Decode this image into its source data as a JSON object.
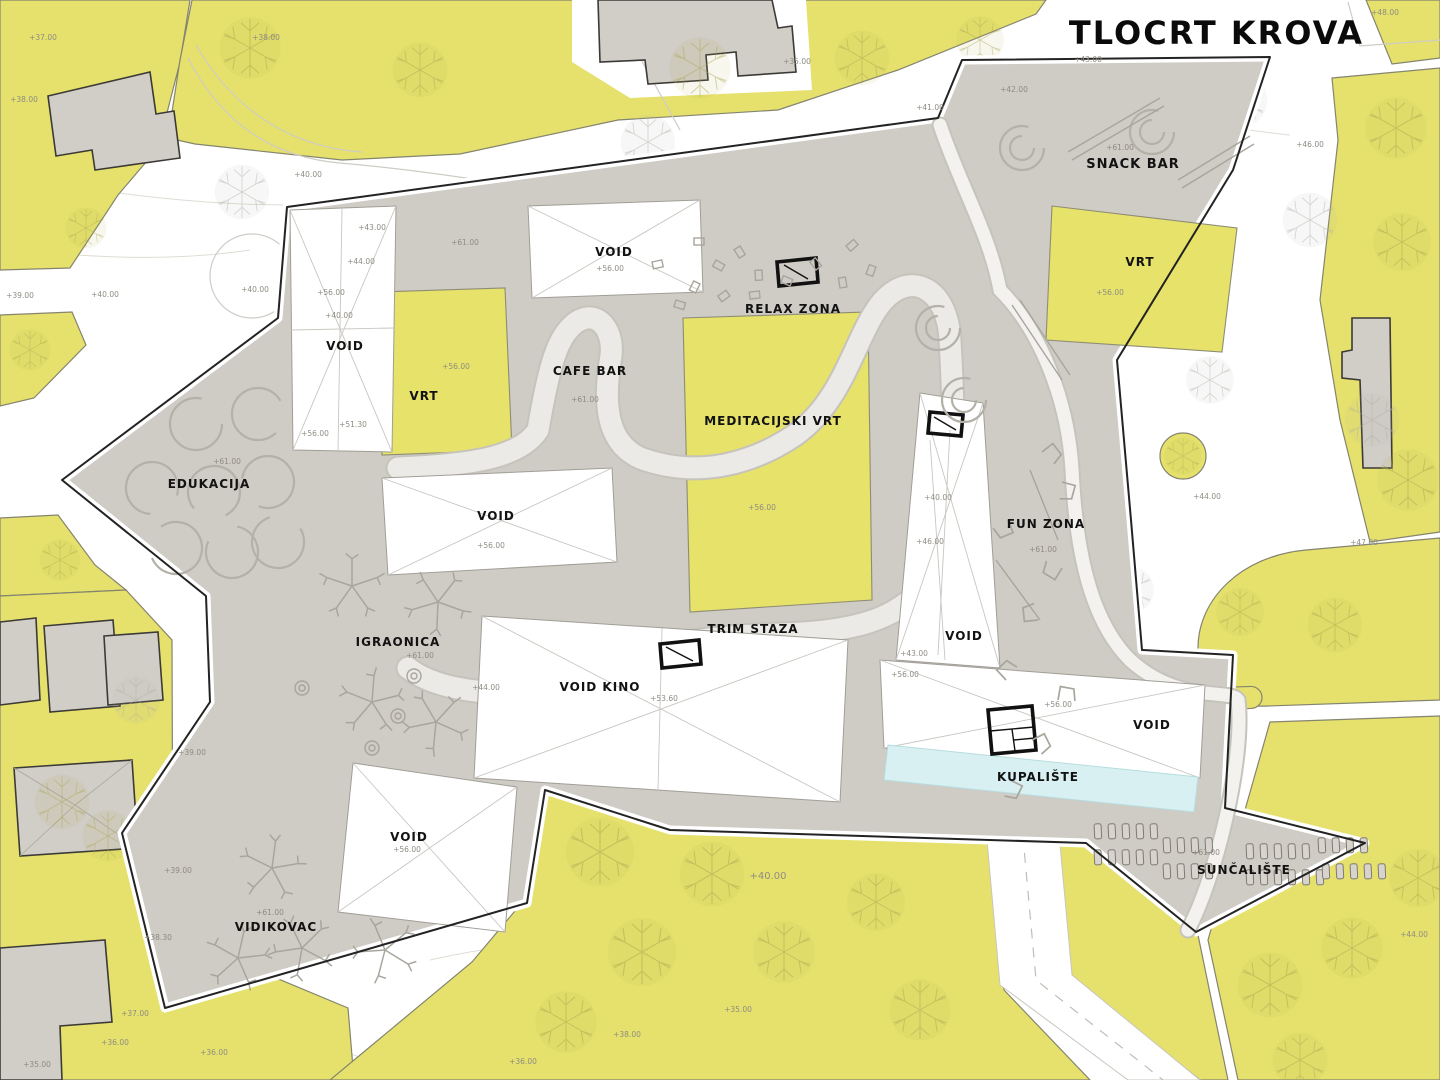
{
  "title": "TLOCRT KROVA",
  "colors": {
    "parcel_yellow": "#e5e16c",
    "roof_grey": "#cfcbc5",
    "building_grey": "#d1cdc7",
    "pool_cyan": "#d9f0f2",
    "outline_black": "#232323",
    "label_black": "#121212",
    "elevation_grey": "#8f8c83"
  },
  "plan": {
    "zones": [
      {
        "id": "snack-bar",
        "text": "SNACK BAR",
        "x": 1133,
        "y": 168,
        "size": 13
      },
      {
        "id": "vrt-right",
        "text": "VRT",
        "x": 1140,
        "y": 266,
        "size": 12
      },
      {
        "id": "void-top",
        "text": "VOID",
        "x": 614,
        "y": 256,
        "size": 12
      },
      {
        "id": "relax-zona",
        "text": "RELAX ZONA",
        "x": 793,
        "y": 313,
        "size": 12
      },
      {
        "id": "cafe-bar",
        "text": "CAFE BAR",
        "x": 590,
        "y": 375,
        "size": 12
      },
      {
        "id": "meditacijski-vrt",
        "text": "MEDITACIJSKI VRT",
        "x": 773,
        "y": 425,
        "size": 12
      },
      {
        "id": "void-left",
        "text": "VOID",
        "x": 345,
        "y": 350,
        "size": 12
      },
      {
        "id": "vrt-left",
        "text": "VRT",
        "x": 424,
        "y": 400,
        "size": 12
      },
      {
        "id": "edukacija",
        "text": "EDUKACIJA",
        "x": 209,
        "y": 488,
        "size": 12
      },
      {
        "id": "fun-zona",
        "text": "FUN ZONA",
        "x": 1046,
        "y": 528,
        "size": 12
      },
      {
        "id": "void-tower",
        "text": "VOID",
        "x": 964,
        "y": 640,
        "size": 12
      },
      {
        "id": "void-center",
        "text": "VOID",
        "x": 496,
        "y": 520,
        "size": 12
      },
      {
        "id": "igraonica",
        "text": "IGRAONICA",
        "x": 398,
        "y": 646,
        "size": 12
      },
      {
        "id": "trim-staza",
        "text": "TRIM STAZA",
        "x": 753,
        "y": 633,
        "size": 12
      },
      {
        "id": "void-kino",
        "text": "VOID KINO",
        "x": 600,
        "y": 691,
        "size": 12
      },
      {
        "id": "void-pool",
        "text": "VOID",
        "x": 1152,
        "y": 729,
        "size": 12
      },
      {
        "id": "kupaliste",
        "text": "KUPALIŠTE",
        "x": 1038,
        "y": 781,
        "size": 12
      },
      {
        "id": "suncaliste",
        "text": "SUNČALIŠTE",
        "x": 1244,
        "y": 874,
        "size": 12
      },
      {
        "id": "vidikovac",
        "text": "VIDIKOVAC",
        "x": 276,
        "y": 931,
        "size": 12
      },
      {
        "id": "void-bottom",
        "text": "VOID",
        "x": 409,
        "y": 841,
        "size": 12
      }
    ],
    "elevations": [
      {
        "text": "+37.00",
        "x": 43,
        "y": 40
      },
      {
        "text": "+38.00",
        "x": 24,
        "y": 102
      },
      {
        "text": "+38.00",
        "x": 266,
        "y": 40
      },
      {
        "text": "+39.00",
        "x": 20,
        "y": 298
      },
      {
        "text": "+40.00",
        "x": 105,
        "y": 297
      },
      {
        "text": "+40.00",
        "x": 255,
        "y": 292
      },
      {
        "text": "+40.00",
        "x": 308,
        "y": 177
      },
      {
        "text": "+35.00",
        "x": 797,
        "y": 64
      },
      {
        "text": "+41.00",
        "x": 930,
        "y": 110
      },
      {
        "text": "+42.00",
        "x": 1014,
        "y": 92
      },
      {
        "text": "+43.00",
        "x": 1088,
        "y": 62
      },
      {
        "text": "+48.00",
        "x": 1385,
        "y": 15
      },
      {
        "text": "+46.00",
        "x": 1310,
        "y": 147
      },
      {
        "text": "+44.00",
        "x": 1207,
        "y": 499
      },
      {
        "text": "+47.00",
        "x": 1364,
        "y": 545
      },
      {
        "text": "+44.00",
        "x": 1414,
        "y": 937
      },
      {
        "text": "+61.00",
        "x": 1120,
        "y": 150
      },
      {
        "text": "+56.00",
        "x": 1110,
        "y": 295
      },
      {
        "text": "+56.00",
        "x": 610,
        "y": 271
      },
      {
        "text": "+61.00",
        "x": 465,
        "y": 245
      },
      {
        "text": "+61.00",
        "x": 585,
        "y": 402
      },
      {
        "text": "+56.00",
        "x": 762,
        "y": 510
      },
      {
        "text": "+43.00",
        "x": 372,
        "y": 230
      },
      {
        "text": "+44.00",
        "x": 361,
        "y": 264
      },
      {
        "text": "+56.00",
        "x": 331,
        "y": 295
      },
      {
        "text": "+40.00",
        "x": 339,
        "y": 318
      },
      {
        "text": "+51.30",
        "x": 353,
        "y": 427
      },
      {
        "text": "+56.00",
        "x": 315,
        "y": 436
      },
      {
        "text": "+56.00",
        "x": 456,
        "y": 369
      },
      {
        "text": "+61.00",
        "x": 227,
        "y": 464
      },
      {
        "text": "+61.00",
        "x": 1043,
        "y": 552
      },
      {
        "text": "+40.00",
        "x": 938,
        "y": 500
      },
      {
        "text": "+46.00",
        "x": 930,
        "y": 544
      },
      {
        "text": "+43.00",
        "x": 914,
        "y": 656
      },
      {
        "text": "+56.00",
        "x": 905,
        "y": 677
      },
      {
        "text": "+56.00",
        "x": 491,
        "y": 548
      },
      {
        "text": "+61.00",
        "x": 420,
        "y": 658
      },
      {
        "text": "+44.00",
        "x": 486,
        "y": 690
      },
      {
        "text": "+53.60",
        "x": 664,
        "y": 701
      },
      {
        "text": "+56.00",
        "x": 1058,
        "y": 707
      },
      {
        "text": "+61.00",
        "x": 1206,
        "y": 855
      },
      {
        "text": "+61.00",
        "x": 270,
        "y": 915
      },
      {
        "text": "+56.00",
        "x": 407,
        "y": 852
      },
      {
        "text": "+40.00",
        "x": 768,
        "y": 879,
        "size": 10
      },
      {
        "text": "+39.00",
        "x": 192,
        "y": 755
      },
      {
        "text": "+39.00",
        "x": 178,
        "y": 873
      },
      {
        "text": "+38.30",
        "x": 158,
        "y": 940
      },
      {
        "text": "+37.00",
        "x": 135,
        "y": 1016
      },
      {
        "text": "+36.00",
        "x": 115,
        "y": 1045
      },
      {
        "text": "+35.00",
        "x": 37,
        "y": 1067
      },
      {
        "text": "+36.00",
        "x": 214,
        "y": 1055
      },
      {
        "text": "+35.00",
        "x": 738,
        "y": 1012
      },
      {
        "text": "+38.00",
        "x": 627,
        "y": 1037
      },
      {
        "text": "+36.00",
        "x": 523,
        "y": 1064
      }
    ]
  }
}
